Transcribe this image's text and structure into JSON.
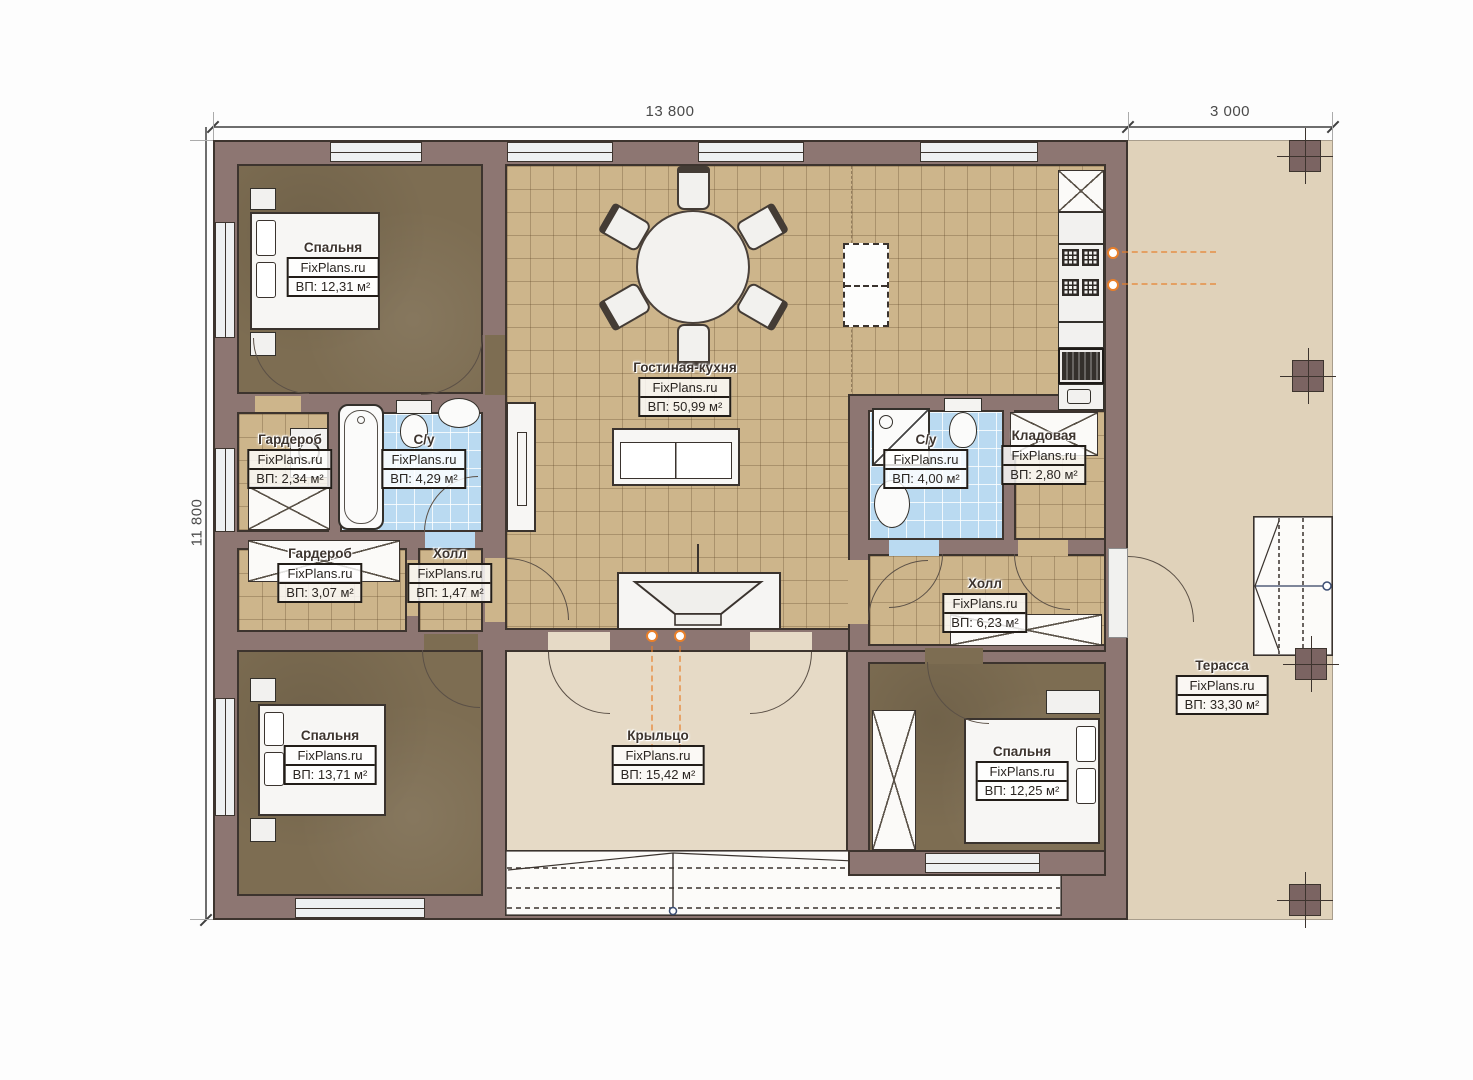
{
  "brand": "FixPlans.ru",
  "dimensions": {
    "width_main": "13 800",
    "width_terrace": "3 000",
    "height": "11 800"
  },
  "rooms": [
    {
      "id": "bedroom-1",
      "name": "Спальня",
      "area": "ВП: 12,31 м²"
    },
    {
      "id": "living-kitchen",
      "name": "Гостиная-кухня",
      "area": "ВП: 50,99 м²"
    },
    {
      "id": "wardrobe-1",
      "name": "Гардероб",
      "area": "ВП: 2,34 м²"
    },
    {
      "id": "bathroom-1",
      "name": "С/у",
      "area": "ВП: 4,29 м²"
    },
    {
      "id": "wardrobe-2",
      "name": "Гардероб",
      "area": "ВП: 3,07 м²"
    },
    {
      "id": "hall-1",
      "name": "Холл",
      "area": "ВП: 1,47 м²"
    },
    {
      "id": "bedroom-2",
      "name": "Спальня",
      "area": "ВП: 13,71 м²"
    },
    {
      "id": "porch",
      "name": "Крыльцо",
      "area": "ВП: 15,42 м²"
    },
    {
      "id": "bathroom-2",
      "name": "С/у",
      "area": "ВП: 4,00 м²"
    },
    {
      "id": "storage",
      "name": "Кладовая",
      "area": "ВП: 2,80 м²"
    },
    {
      "id": "hall-2",
      "name": "Холл",
      "area": "ВП: 6,23 м²"
    },
    {
      "id": "bedroom-3",
      "name": "Спальня",
      "area": "ВП: 12,25 м²"
    },
    {
      "id": "terrace",
      "name": "Терасса",
      "area": "ВП: 33,30 м²"
    }
  ],
  "colors": {
    "wall": "#8d7672",
    "outline_ink": "#3d342e",
    "tile_tan": "#cdb58b",
    "tile_blue": "#badaf1",
    "bedroom_floor": "#7d6d52",
    "porch_floor": "#e6dac6",
    "terrace_floor": "#e0d2ba",
    "accent_orange": "#e87f2a"
  }
}
